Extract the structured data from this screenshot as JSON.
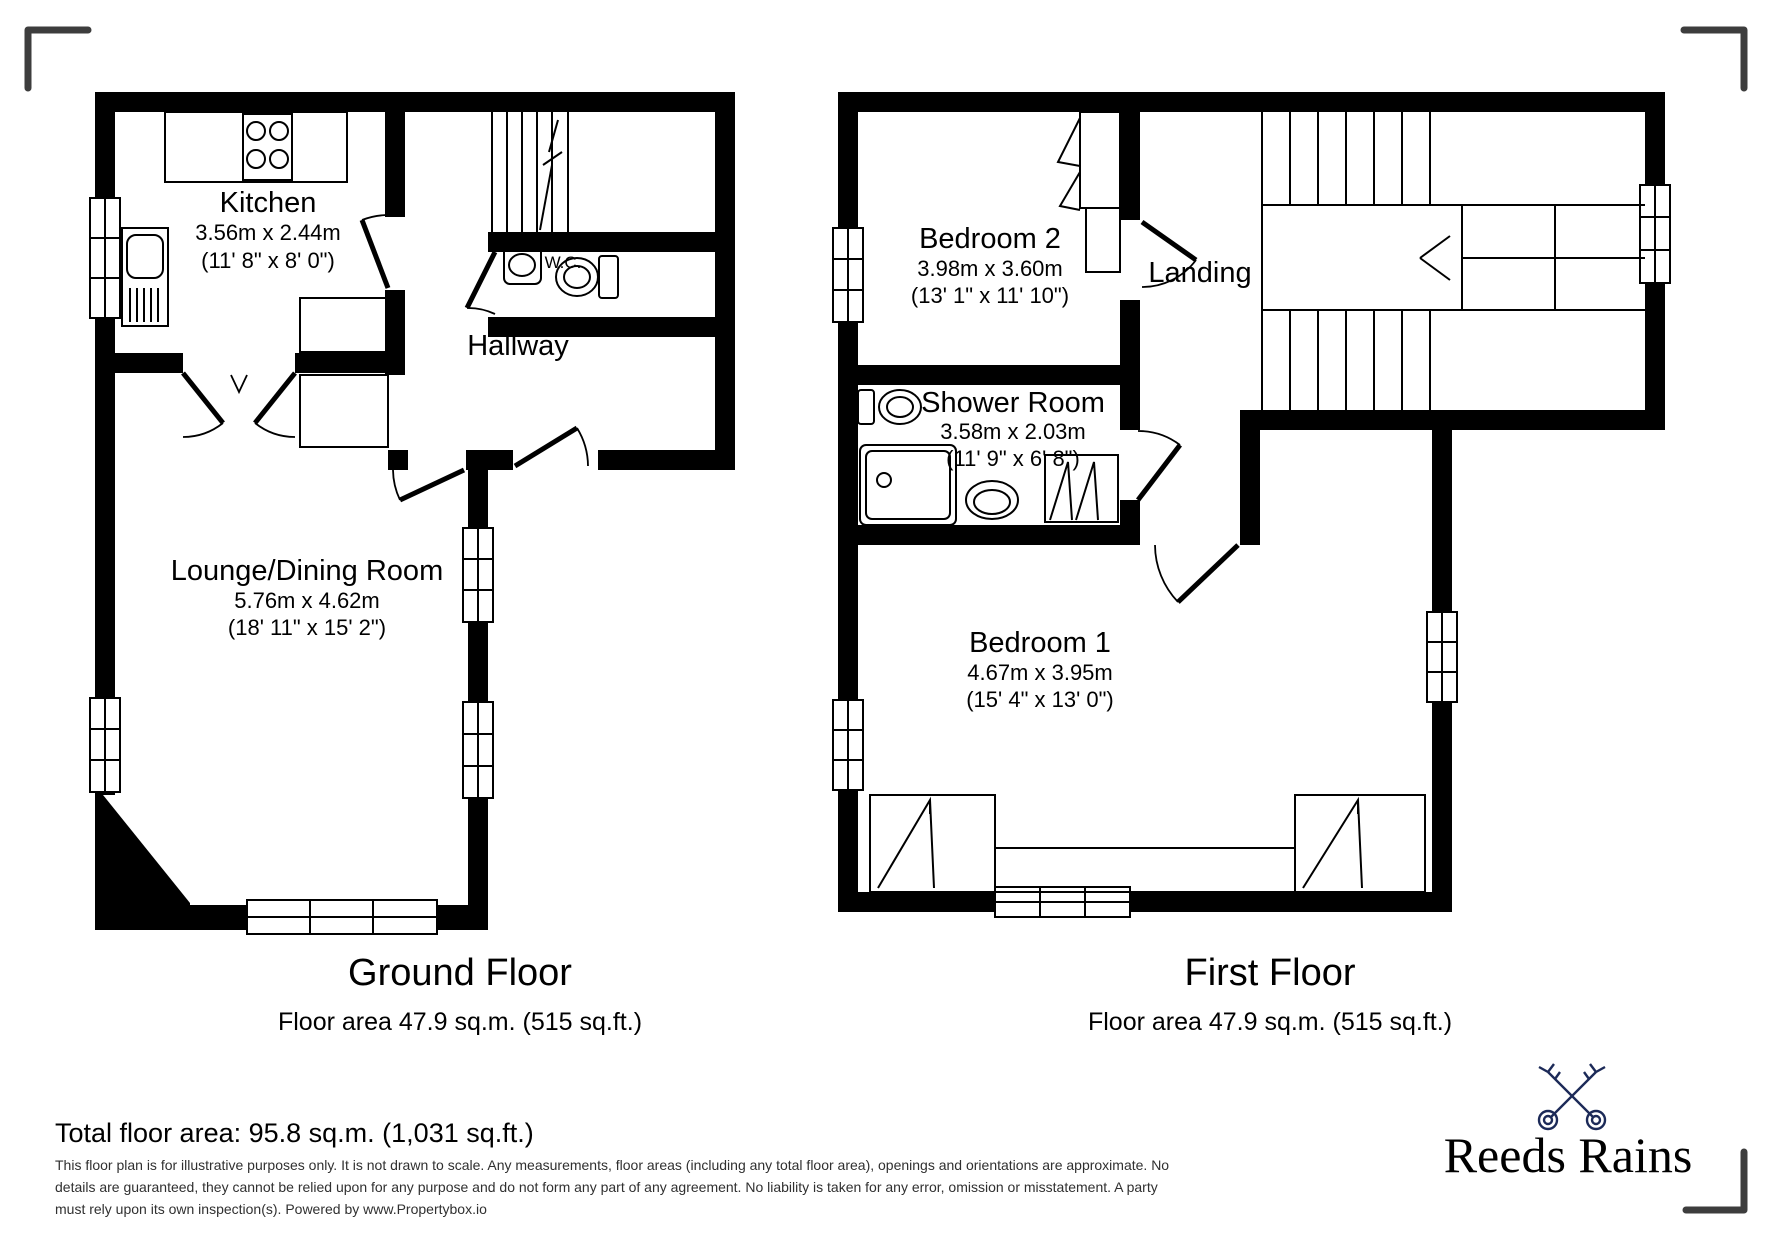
{
  "page": {
    "background": "#ffffff"
  },
  "ground_floor": {
    "title": "Ground Floor",
    "area": "Floor area 47.9 sq.m. (515 sq.ft.)",
    "rooms": {
      "kitchen": {
        "name": "Kitchen",
        "metric": "3.56m x 2.44m",
        "imperial": "(11' 8\" x 8' 0\")"
      },
      "hallway": {
        "name": "Hallway"
      },
      "wc": {
        "name": "W.C."
      },
      "lounge": {
        "name": "Lounge/Dining Room",
        "metric": "5.76m x 4.62m",
        "imperial": "(18' 11\" x 15' 2\")"
      }
    }
  },
  "first_floor": {
    "title": "First Floor",
    "area": "Floor area 47.9 sq.m. (515 sq.ft.)",
    "rooms": {
      "bedroom2": {
        "name": "Bedroom 2",
        "metric": "3.98m x 3.60m",
        "imperial": "(13' 1\" x 11' 10\")"
      },
      "landing": {
        "name": "Landing"
      },
      "shower": {
        "name": "Shower Room",
        "metric": "3.58m x 2.03m",
        "imperial": "(11' 9\" x 6' 8\")"
      },
      "bedroom1": {
        "name": "Bedroom 1",
        "metric": "4.67m x 3.95m",
        "imperial": "(15' 4\" x 13' 0\")"
      }
    }
  },
  "footer": {
    "total": "Total floor area: 95.8 sq.m. (1,031 sq.ft.)",
    "disclaimer_line1": "This floor plan is for illustrative purposes only. It is not drawn to scale. Any measurements, floor areas (including any total floor area), openings and orientations are approximate. No",
    "disclaimer_line2": "details are guaranteed, they cannot be relied upon for any purpose and do not form any part of any agreement. No liability is taken for any error, omission or misstatement. A party",
    "disclaimer_line3": "must rely upon its own inspection(s). Powered by www.Propertybox.io"
  },
  "logo": {
    "brand": "Reeds Rains",
    "accent": "#1c2a58"
  }
}
